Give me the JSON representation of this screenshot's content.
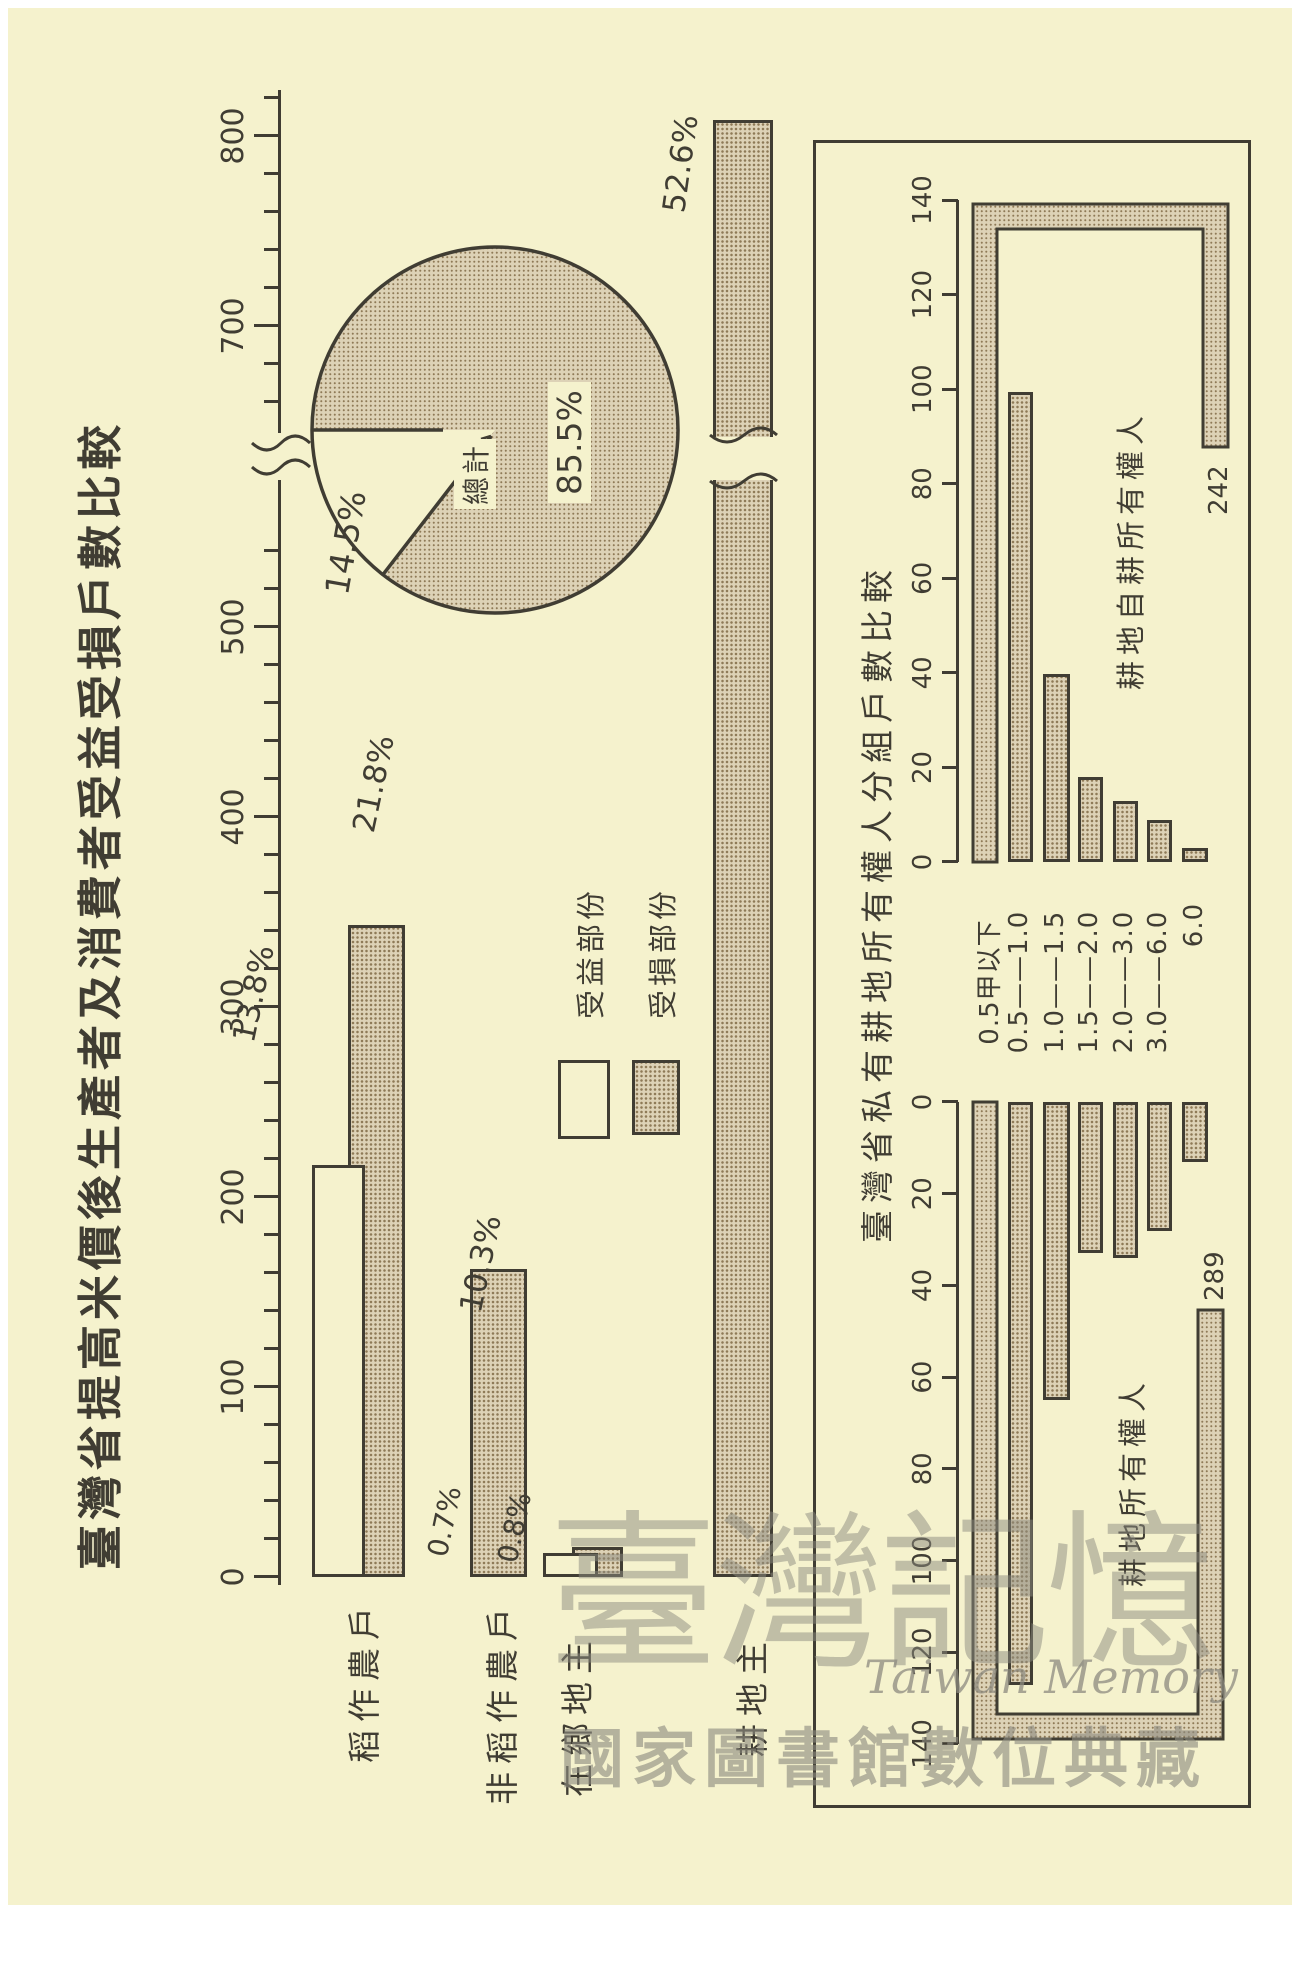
{
  "page_title": "臺灣省提高米價後生產者及消費者受益受損戶數比較",
  "main_chart": {
    "axis": {
      "tick_labels": [
        "0",
        "100",
        "200",
        "300",
        "400",
        "500",
        "700",
        "800"
      ],
      "max": 800,
      "break_between": [
        500,
        700
      ],
      "minor_step": 20
    },
    "categories": [
      {
        "label": "稻作農戶",
        "benefit_pct": "13.8%",
        "loss_pct": "21.8%"
      },
      {
        "label": "非稻作農戶",
        "loss_pct": "10.3%"
      },
      {
        "label": "在鄉地主",
        "benefit_pct": "0.7%",
        "loss_pct": "0.8%"
      },
      {
        "label": "耕地主",
        "loss_pct": "52.6%"
      }
    ],
    "legend": {
      "benefit": "受益部份",
      "loss": "受損部份"
    }
  },
  "pie": {
    "label": "總計",
    "benefit_pct": "14.5%",
    "loss_pct": "85.5%"
  },
  "owners_chart": {
    "title": "臺灣省私有耕地所有權人分組戶數比較",
    "axis_tick_labels": [
      "0",
      "20",
      "40",
      "60",
      "80",
      "100",
      "120",
      "140"
    ],
    "groups": [
      "0.5甲以下",
      "0.5——1.0",
      "1.0——1.5",
      "1.5——2.0",
      "2.0——3.0",
      "3.0——6.0",
      "6.0"
    ],
    "left_series": {
      "name": "耕地所有權人",
      "first_bar_label": "289"
    },
    "right_series": {
      "name": "耕地自耕所有權人",
      "first_bar_label": "242"
    }
  },
  "watermark": {
    "script": "臺灣記憶",
    "latin": "Taiwan Memory",
    "bottom": "國家圖書館數位典藏"
  },
  "chart_data": [
    {
      "type": "bar",
      "title": "臺灣省提高米價後生產者及消費者受益受損戶數比較",
      "orientation": "horizontal",
      "categories": [
        "稻作農戶",
        "非稻作農戶",
        "在鄉地主",
        "耕地主"
      ],
      "series": [
        {
          "name": "受益部份",
          "values": [
            217,
            null,
            11,
            null
          ],
          "pct_labels": [
            "13.8%",
            null,
            "0.7%",
            null
          ]
        },
        {
          "name": "受損部份",
          "values": [
            343,
            162,
            13,
            828
          ],
          "pct_labels": [
            "21.8%",
            "10.3%",
            "0.8%",
            "52.6%"
          ]
        }
      ],
      "xlabel": "",
      "ylabel": "",
      "xlim": [
        0,
        830
      ],
      "axis_break": [
        520,
        680
      ],
      "grid": false,
      "legend_position": "middle-left"
    },
    {
      "type": "pie",
      "title": "總計",
      "labels": [
        "受損部份",
        "受益部份"
      ],
      "values": [
        85.5,
        14.5
      ],
      "unit": "%"
    },
    {
      "type": "bar",
      "title": "臺灣省私有耕地所有權人分組戶數比較",
      "orientation": "horizontal-back-to-back",
      "categories": [
        "0.5甲以下",
        "0.5——1.0",
        "1.0——1.5",
        "1.5——2.0",
        "2.0——3.0",
        "3.0——6.0",
        "6.0"
      ],
      "series": [
        {
          "name": "耕地所有權人",
          "direction": "left",
          "values": [
            289,
            127,
            65,
            33,
            34,
            28,
            13
          ]
        },
        {
          "name": "耕地自耕所有權人",
          "direction": "right",
          "values": [
            242,
            100,
            40,
            18,
            13,
            9,
            2
          ]
        }
      ],
      "xlim": [
        0,
        140
      ],
      "tick_step": 20,
      "folded_bars": {
        "耕地所有權人": 289,
        "耕地自耕所有權人": 242
      },
      "grid": false
    }
  ]
}
